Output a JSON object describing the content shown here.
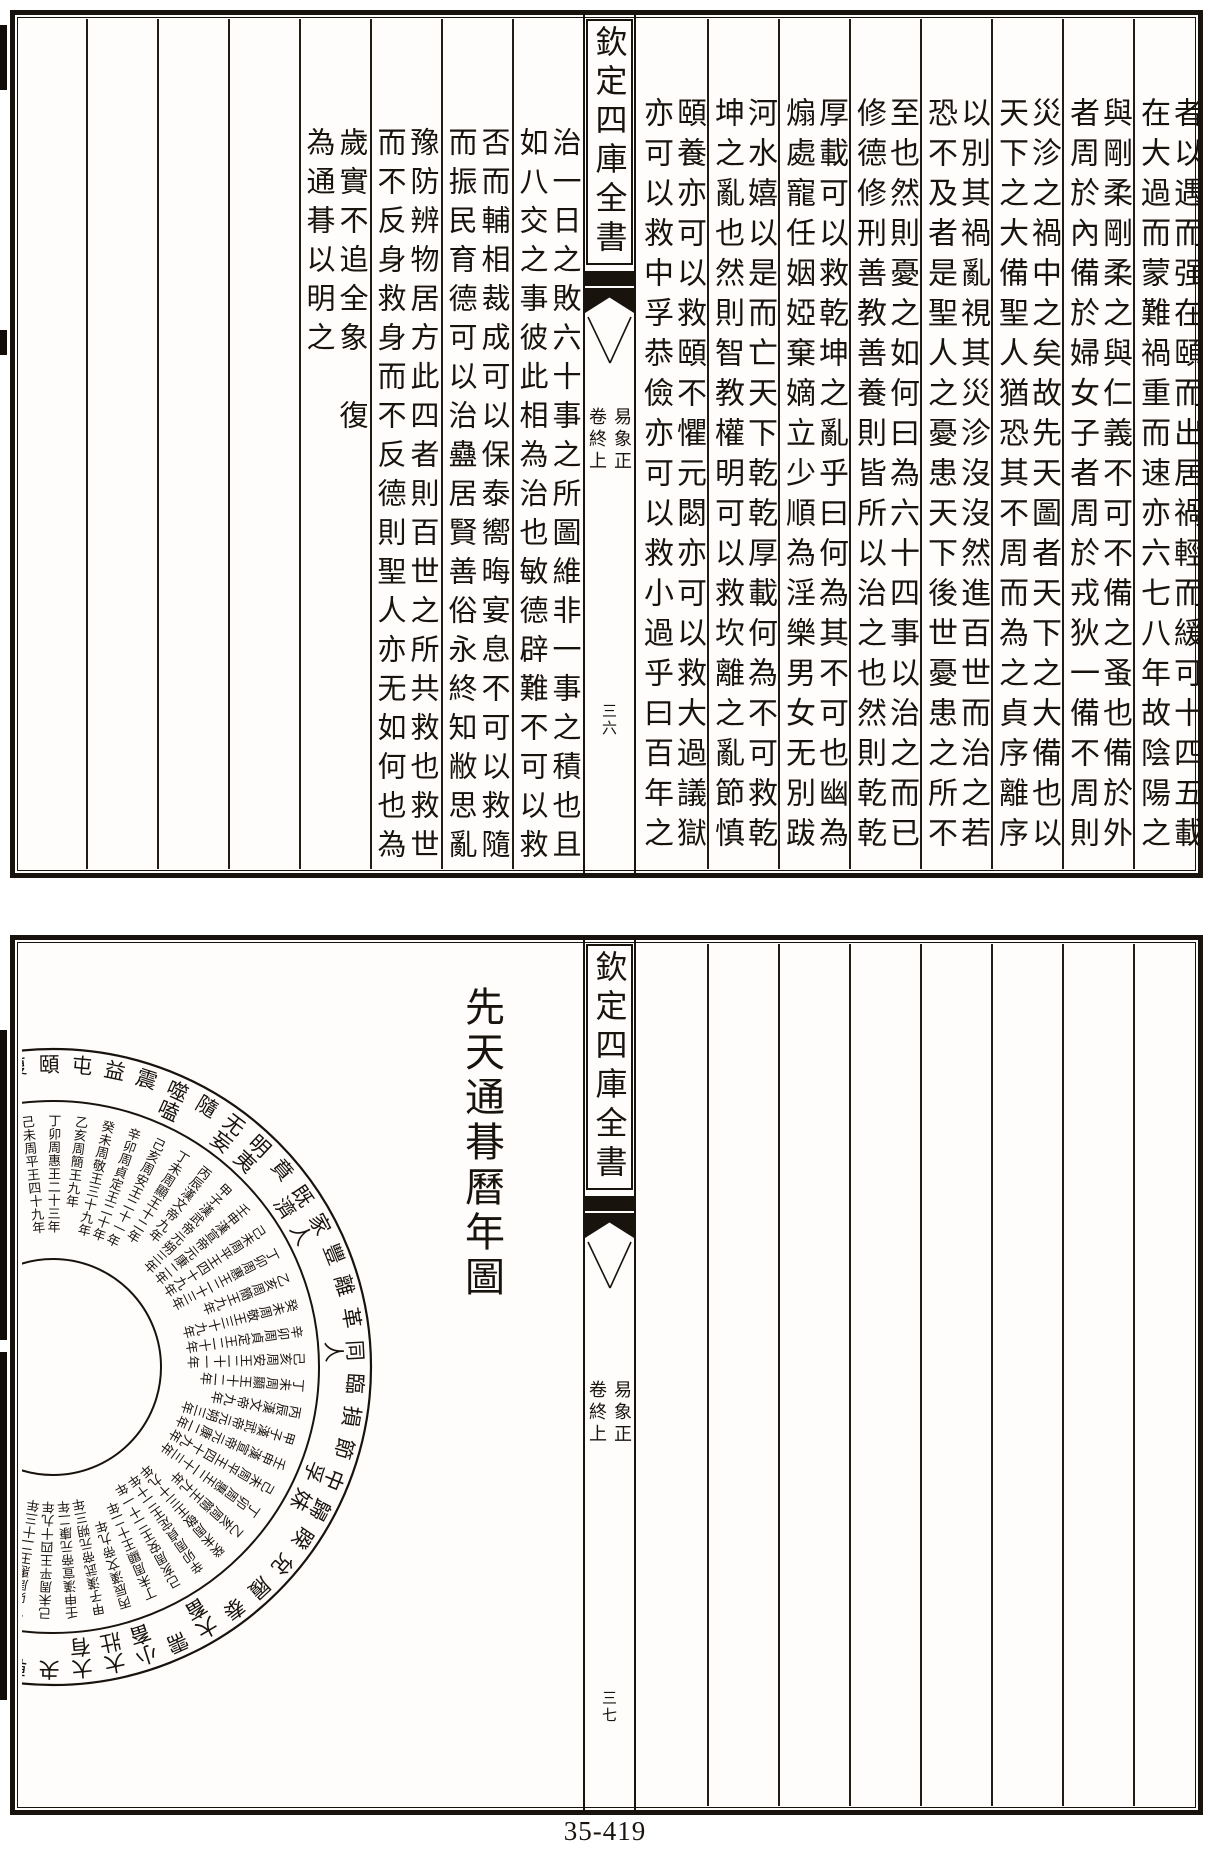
{
  "colors": {
    "ink": "#19130e",
    "paper": "#fefdfb"
  },
  "page_footer": {
    "catalog_number": "35-419"
  },
  "top_page": {
    "banxin": {
      "title": "欽定四庫全書",
      "book": "易象正",
      "chapter": "卷終上",
      "page_number": "三六"
    },
    "right_columns": [
      "者以遇而强在頤而出居禍輕而緩可十四五載",
      "在大過而蒙難禍重而速亦六七八年故陰陽之",
      "與剛柔剛柔之與仁義不可不備之蚤也備於外",
      "者周於內備於婦女子者周於戎狄一備不周則",
      "災沴之禍中之矣故先天圖者天下之大備也以",
      "天下之大備聖人猶恐其不周而為之貞序離序",
      "以別其禍亂視其災沴沒沒然進百世而治之若",
      "恐不及者是聖人之憂患天下後世憂患之所不",
      "至也然則憂之如何曰為六十四事以治之而已",
      "修德修刑善教善養則皆所以治之也然則乾乾",
      "厚載可以救乾坤之亂乎曰何為其不可也幽為",
      "煽處寵任姻婭棄嫡立少順為淫樂男女无別跋",
      "河水嬉以是而亡天下乾乾厚載何為不可救乾",
      "坤之亂也然則智教權明可以救坎離之亂節慎",
      "頤養亦可以救頤不懼元閟亦可以救大過議獄",
      "亦可以救中孚恭儉亦可以救小過乎曰百年之"
    ],
    "left_columns": [
      "治一日之敗六十事之所圖維非一事之積也且",
      "如八交之事彼此相為治也敏德辟難不可以救",
      "否而輔相裁成可以保泰嚮晦宴息不可以救隨",
      "而振民育德可以治蠱居賢善俗永終知敝思亂",
      "豫防辨物居方此四者則百世之所共救也救世",
      "而不反身救身而不反德則聖人亦无如何也為",
      "歲實不追全象　復",
      "為通朞以明之"
    ]
  },
  "bottom_page": {
    "banxin": {
      "title": "欽定四庫全書",
      "book": "易象正",
      "chapter": "卷終上",
      "page_number": "三七"
    },
    "diagram_title": "先天通朞曆年圖",
    "circle": {
      "hexagram_ring": [
        "復",
        "頤",
        "屯",
        "益",
        "震",
        "噬嗑",
        "隨",
        "无妄",
        "明夷",
        "賁",
        "既濟",
        "家人",
        "豐",
        "離",
        "革",
        "同人",
        "臨",
        "損",
        "節",
        "中孚",
        "歸妹",
        "睽",
        "兌",
        "履",
        "泰",
        "大畜",
        "需",
        "小畜",
        "大壯",
        "大有",
        "夬",
        "乾"
      ],
      "year_ring_entries": [
        "己未周平王四十九年",
        "丁卯周惠王二十三年",
        "乙亥周簡王九年",
        "癸未周敬王三十九年",
        "辛卯周貞定王二十年",
        "己亥周安王二十一年",
        "丁未周顯王十二年",
        "丙辰漢文帝九年",
        "甲子漢武帝元朔三年",
        "壬申漢宣帝元康二年"
      ]
    }
  }
}
